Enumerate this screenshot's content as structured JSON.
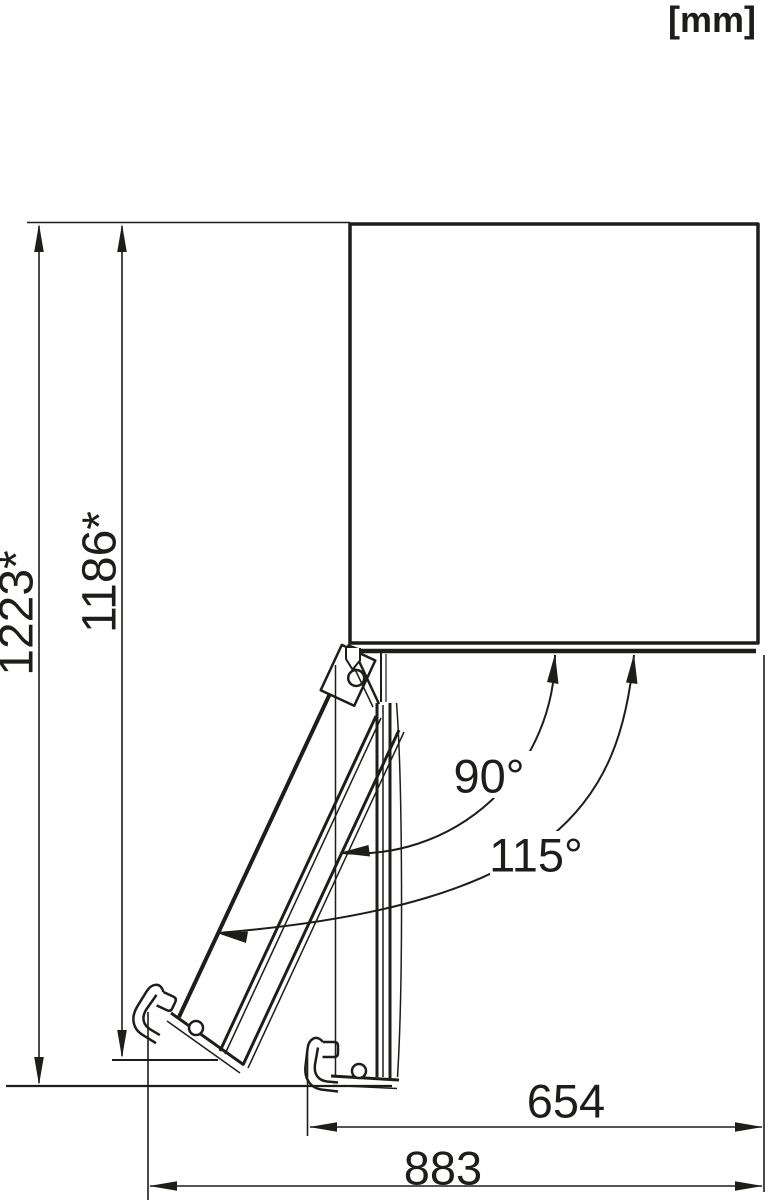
{
  "unit_badge": "[mm]",
  "dimensions": {
    "vertical": [
      "1223*",
      "1186*"
    ],
    "horizontal": [
      "654",
      "883"
    ],
    "angles": [
      "90°",
      "115°"
    ]
  },
  "colors": {
    "line": "#1d1d1b",
    "background": "#ffffff"
  }
}
